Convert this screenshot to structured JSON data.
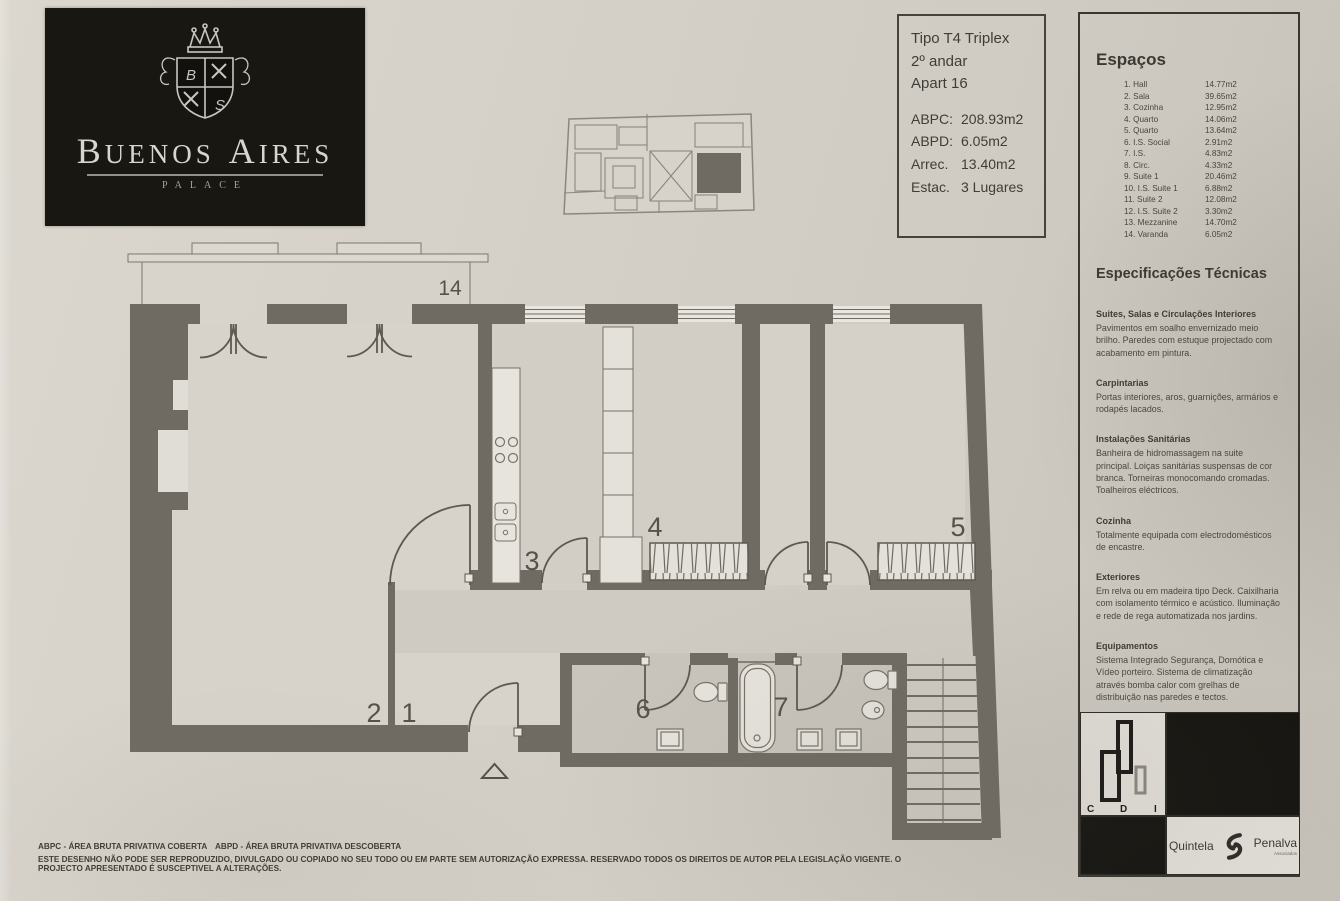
{
  "logo": {
    "word1": "Buenos",
    "word2": "Aires",
    "subtitle": "PALACE"
  },
  "info_box": {
    "type": "Tipo T4 Triplex",
    "floor": "2º andar",
    "apartment": "Apart 16",
    "metrics": [
      {
        "label": "ABPC:",
        "value": "208.93m2"
      },
      {
        "label": "ABPD:",
        "value": "6.05m2"
      },
      {
        "label": "Arrec.",
        "value": "13.40m2"
      },
      {
        "label": "Estac.",
        "value": "3 Lugares"
      }
    ]
  },
  "spaces": {
    "title": "Espaços",
    "items": [
      {
        "label": "1. Hall",
        "area": "14.77m2"
      },
      {
        "label": "2. Sala",
        "area": "39.65m2"
      },
      {
        "label": "3. Cozinha",
        "area": "12.95m2"
      },
      {
        "label": "4. Quarto",
        "area": "14.06m2"
      },
      {
        "label": "5. Quarto",
        "area": "13.64m2"
      },
      {
        "label": "6. I.S. Social",
        "area": "2.91m2"
      },
      {
        "label": "7. I.S.",
        "area": "4.83m2"
      },
      {
        "label": "8. Circ.",
        "area": "4.33m2"
      },
      {
        "label": "9. Suite 1",
        "area": "20.46m2"
      },
      {
        "label": "10. I.S. Suite 1",
        "area": "6.88m2"
      },
      {
        "label": "11. Suite 2",
        "area": "12.08m2"
      },
      {
        "label": "12. I.S. Suite 2",
        "area": "3.30m2"
      },
      {
        "label": "13. Mezzanine",
        "area": "14.70m2"
      },
      {
        "label": "14. Varanda",
        "area": "6.05m2"
      }
    ]
  },
  "specs": {
    "title": "Especificações Técnicas",
    "sections": [
      {
        "heading": "Suites, Salas e Circulações Interiores",
        "body": "Pavimentos em soalho envernizado meio brilho. Paredes com estuque projectado com acabamento em pintura."
      },
      {
        "heading": "Carpintarias",
        "body": "Portas interiores, aros, guarnições, armários e rodapés lacados."
      },
      {
        "heading": "Instalações Sanitárias",
        "body": "Banheira de hidromassagem na suite principal. Loiças sanitárias suspensas de cor branca. Torneiras monocomando cromadas. Toalheiros eléctricos."
      },
      {
        "heading": "Cozinha",
        "body": "Totalmente equipada com electrodomésticos de encastre."
      },
      {
        "heading": "Exteriores",
        "body": "Em relva ou em madeira tipo Deck. Caixilharia com isolamento térmico e acústico. Iluminação e rede de rega automatizada nos jardins."
      },
      {
        "heading": "Equipamentos",
        "body": "Sistema Integrado Segurança, Domótica e Vídeo porteiro. Sistema de climatização através bomba calor com grelhas de distribuição nas paredes e tectos."
      }
    ]
  },
  "plan": {
    "labels": [
      {
        "text": "14"
      },
      {
        "text": "2"
      },
      {
        "text": "1"
      },
      {
        "text": "3"
      },
      {
        "text": "4"
      },
      {
        "text": "5"
      },
      {
        "text": "6"
      },
      {
        "text": "7"
      }
    ]
  },
  "branding": {
    "cdi": {
      "c": "C",
      "d": "D",
      "i": "I"
    },
    "agency": {
      "name1": "Quintela",
      "name2": "Penalva",
      "sub": "Associados"
    }
  },
  "footer": {
    "abpc_def": "ABPC - ÁREA BRUTA PRIVATIVA COBERTA",
    "abpd_def": "ABPD - ÁREA BRUTA PRIVATIVA DESCOBERTA",
    "notice": "ESTE DESENHO NÃO PODE SER REPRODUZIDO, DIVULGADO OU COPIADO NO SEU TODO OU EM PARTE SEM AUTORIZAÇÃO EXPRESSA. RESERVADO TODOS OS DIREITOS DE AUTOR PELA LEGISLAÇÃO VIGENTE. O PROJECTO APRESENTADO É SUSCEPTIVEL A ALTERAÇÕES."
  }
}
